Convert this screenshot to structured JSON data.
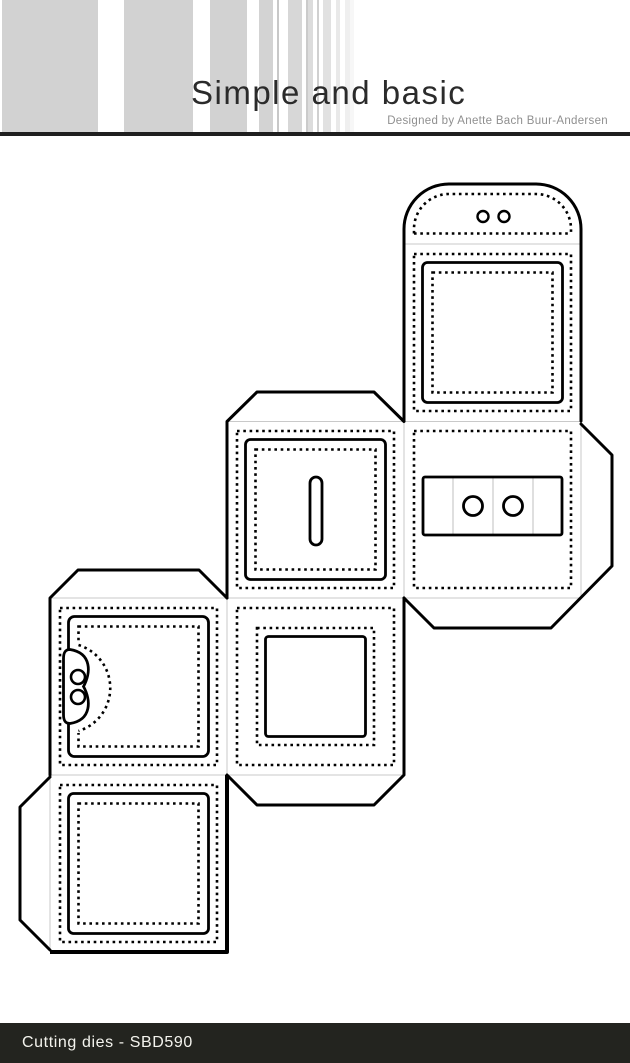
{
  "header": {
    "brand": "Simple and basic",
    "designer": "Designed by Anette Bach Buur-Andersen"
  },
  "footer": {
    "label": "Cutting dies - SBD590",
    "product_type": "Cutting dies",
    "product_code": "SBD590"
  },
  "colors": {
    "stripe_gray": "#d2d2d2",
    "divider_bar": "#1f1f1f",
    "footer_bar": "#23241f",
    "footer_text": "#f4f4ee",
    "cut_line": "#000000",
    "fold_line": "#c9c9c9"
  },
  "diagram": {
    "type": "die-cut box net",
    "description": "Fold-out template for a cube box: six square panels arranged in a staircase with glue tabs, dotted stitch/fold lines, a rounded closure flap with two eyelet holes, a coin slot panel and a tuck-closure front panel.",
    "panels": [
      {
        "name": "closure-flap",
        "features": [
          "rounded dome",
          "stitched border",
          "two eyelet holes"
        ]
      },
      {
        "name": "top-panel",
        "features": [
          "stitched border",
          "square frame",
          "stitched inner square"
        ]
      },
      {
        "name": "back-panel",
        "features": [
          "stitched border",
          "label plate with two eyelet holes",
          "side glue tab",
          "bottom glue tab"
        ]
      },
      {
        "name": "lid-panel",
        "features": [
          "top glue tab",
          "stitched border",
          "square frame",
          "vertical coin slot"
        ]
      },
      {
        "name": "bottom-panel",
        "features": [
          "stitched border",
          "stitched middle square",
          "solid inner square",
          "bottom glue tab"
        ]
      },
      {
        "name": "front-panel",
        "features": [
          "top glue tab",
          "stitched border",
          "square frame",
          "tuck closure tab with two holes"
        ]
      },
      {
        "name": "base-panel",
        "features": [
          "side glue tab",
          "stitched border",
          "square frame",
          "stitched inner square"
        ]
      }
    ]
  }
}
